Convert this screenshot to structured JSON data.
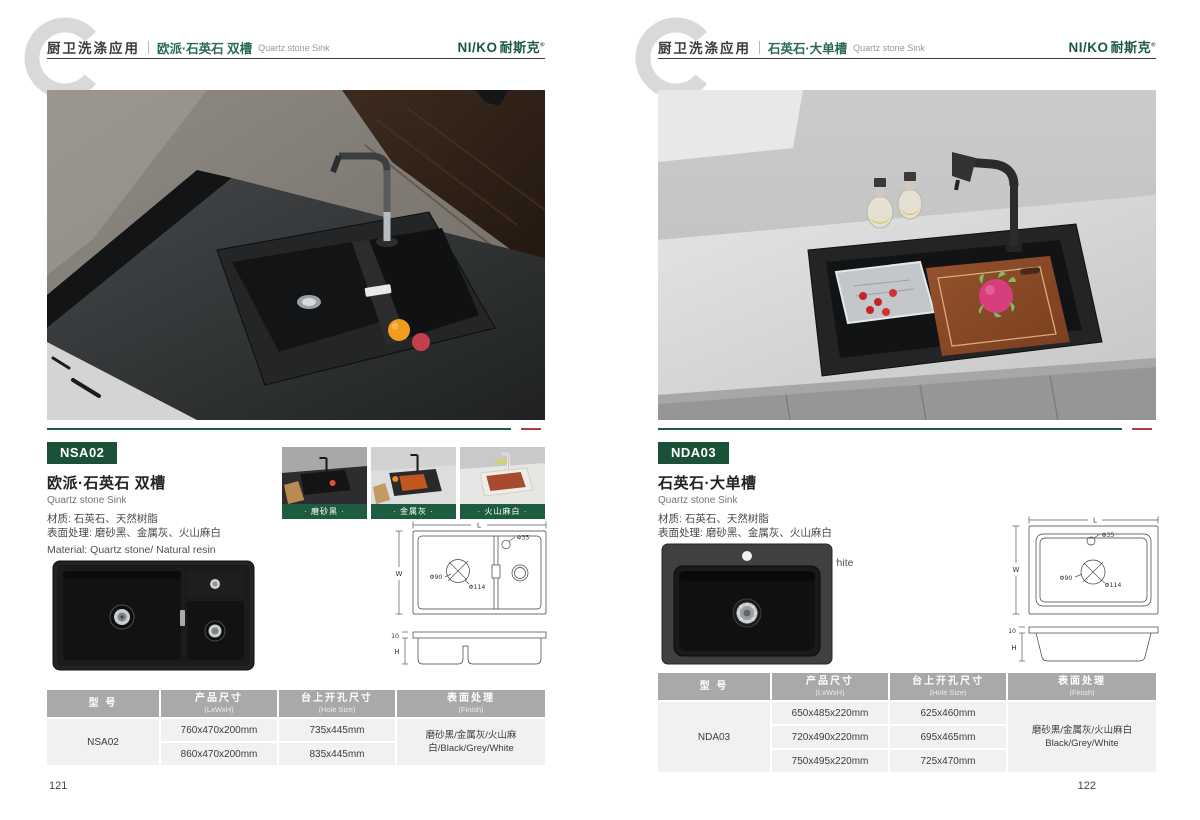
{
  "brand": {
    "logo_en": "NI/KO",
    "logo_cn": "耐斯克",
    "logo_reg": "®"
  },
  "accent": {
    "green": "#1d5c40",
    "badge_green": "#1a5138",
    "red": "#b23c3c",
    "table_header_gray": "#a9a9a9"
  },
  "pages": [
    {
      "page_number": "121",
      "header": {
        "category": "厨卫洗涤应用",
        "title_cn": "欧派·石英石 双槽",
        "title_en": "Quartz stone Sink"
      },
      "product": {
        "model": "NSA02",
        "name_cn": "欧派·石英石 双槽",
        "name_en": "Quartz stone Sink",
        "material_cn": "材质: 石英石、天然树脂",
        "surface_cn": "表面处理: 磨砂黑、金属灰、火山麻白",
        "material_en": "Material: Quartz stone/ Natural resin",
        "finish_en": "Finish: Frosted black/Metal gray/Dot white"
      },
      "swatches": [
        {
          "label": "· 磨砂黑 ·"
        },
        {
          "label": "· 金属灰 ·"
        },
        {
          "label": "· 火山麻白 ·"
        }
      ],
      "drawing": {
        "L": "L",
        "W": "W",
        "H": "H",
        "rim": "10",
        "hole": "Φ35",
        "drain": "Φ90",
        "drain2": "Φ114"
      },
      "table": {
        "headers": [
          {
            "cn": "型 号",
            "en": ""
          },
          {
            "cn": "产品尺寸",
            "en": "(LxWxH)"
          },
          {
            "cn": "台上开孔尺寸",
            "en": "(Hole Size)"
          },
          {
            "cn": "表面处理",
            "en": "(Finish)"
          }
        ],
        "model": "NSA02",
        "rows": [
          {
            "size": "760x470x200mm",
            "hole": "735x445mm"
          },
          {
            "size": "860x470x200mm",
            "hole": "835x445mm"
          }
        ],
        "finish_line1": "磨砂黑/金属灰/火山麻白/Black/Grey/White",
        "finish_line2": ""
      }
    },
    {
      "page_number": "122",
      "header": {
        "category": "厨卫洗涤应用",
        "title_cn": "石英石·大单槽",
        "title_en": "Quartz stone Sink"
      },
      "product": {
        "model": "NDA03",
        "name_cn": "石英石·大单槽",
        "name_en": "Quartz stone Sink",
        "material_cn": "材质: 石英石、天然树脂",
        "surface_cn": "表面处理: 磨砂黑、金属灰、火山麻白",
        "material_en": "Material: Quartz stone/ Natural resin",
        "finish_en": "Finish: Frosted black/Metal gray/Dot white"
      },
      "drawing": {
        "L": "L",
        "W": "W",
        "H": "H",
        "rim": "10",
        "hole": "Φ35",
        "drain": "Φ90",
        "drain2": "Φ114"
      },
      "table": {
        "headers": [
          {
            "cn": "型 号",
            "en": ""
          },
          {
            "cn": "产品尺寸",
            "en": "(LxWxH)"
          },
          {
            "cn": "台上开孔尺寸",
            "en": "(Hole Size)"
          },
          {
            "cn": "表面处理",
            "en": "(Finish)"
          }
        ],
        "model": "NDA03",
        "rows": [
          {
            "size": "650x485x220mm",
            "hole": "625x460mm"
          },
          {
            "size": "720x490x220mm",
            "hole": "695x465mm"
          },
          {
            "size": "750x495x220mm",
            "hole": "725x470mm"
          }
        ],
        "finish_line1": "磨砂黑/金属灰/火山麻白",
        "finish_line2": "Black/Grey/White"
      }
    }
  ]
}
